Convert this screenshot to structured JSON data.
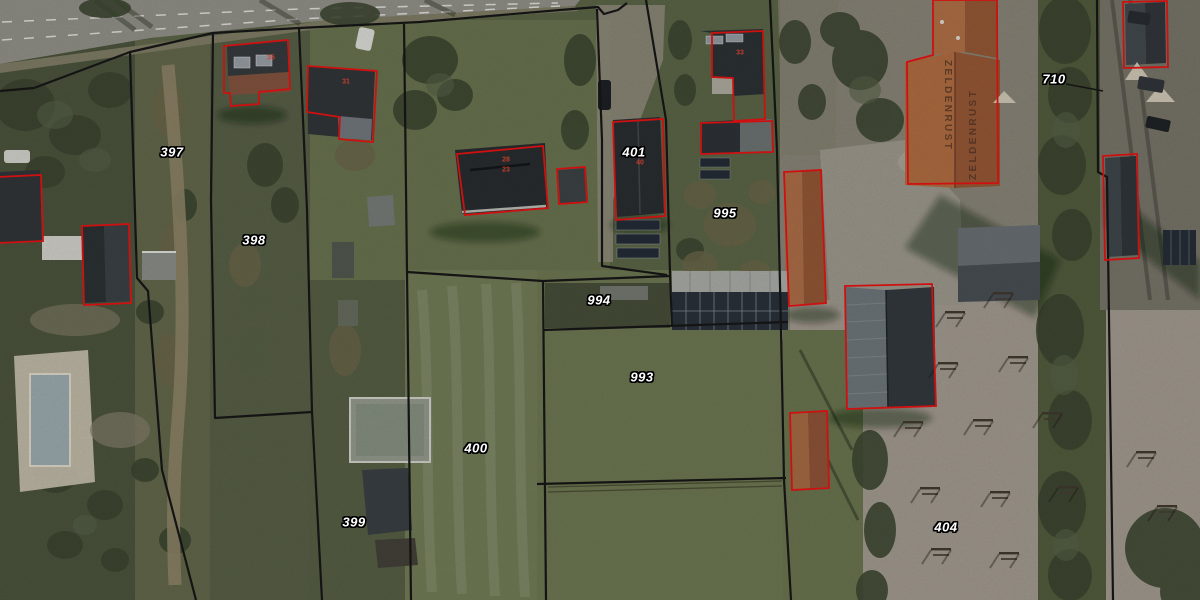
{
  "map": {
    "type": "cadastral-parcel-aerial-view",
    "roof_text": "ZELDENRUST",
    "roof_text_marks": [
      {
        "x": 953,
        "y": 60
      },
      {
        "x": 968,
        "y": 180
      }
    ],
    "parcel_labels": [
      {
        "label": "397",
        "x": 172,
        "y": 152
      },
      {
        "label": "398",
        "x": 254,
        "y": 240
      },
      {
        "label": "399",
        "x": 354,
        "y": 522
      },
      {
        "label": "400",
        "x": 476,
        "y": 448
      },
      {
        "label": "401",
        "x": 634,
        "y": 152
      },
      {
        "label": "404",
        "x": 946,
        "y": 527
      },
      {
        "label": "710",
        "x": 1054,
        "y": 79
      },
      {
        "label": "993",
        "x": 642,
        "y": 377
      },
      {
        "label": "994",
        "x": 599,
        "y": 300
      },
      {
        "label": "995",
        "x": 725,
        "y": 213
      }
    ],
    "house_numbers": [
      {
        "value": "35",
        "x": 271,
        "y": 58
      },
      {
        "value": "31",
        "x": 346,
        "y": 82
      },
      {
        "value": "28",
        "x": 506,
        "y": 160
      },
      {
        "value": "23",
        "x": 506,
        "y": 170
      },
      {
        "value": "33",
        "x": 740,
        "y": 53
      },
      {
        "value": "40",
        "x": 640,
        "y": 163
      }
    ],
    "colors": {
      "boundary": "#141414",
      "building_outline": "#cf1010",
      "parcel_label": "#ffffff",
      "house_number": "#d9402c",
      "roof_text": "#4a2f22"
    }
  }
}
